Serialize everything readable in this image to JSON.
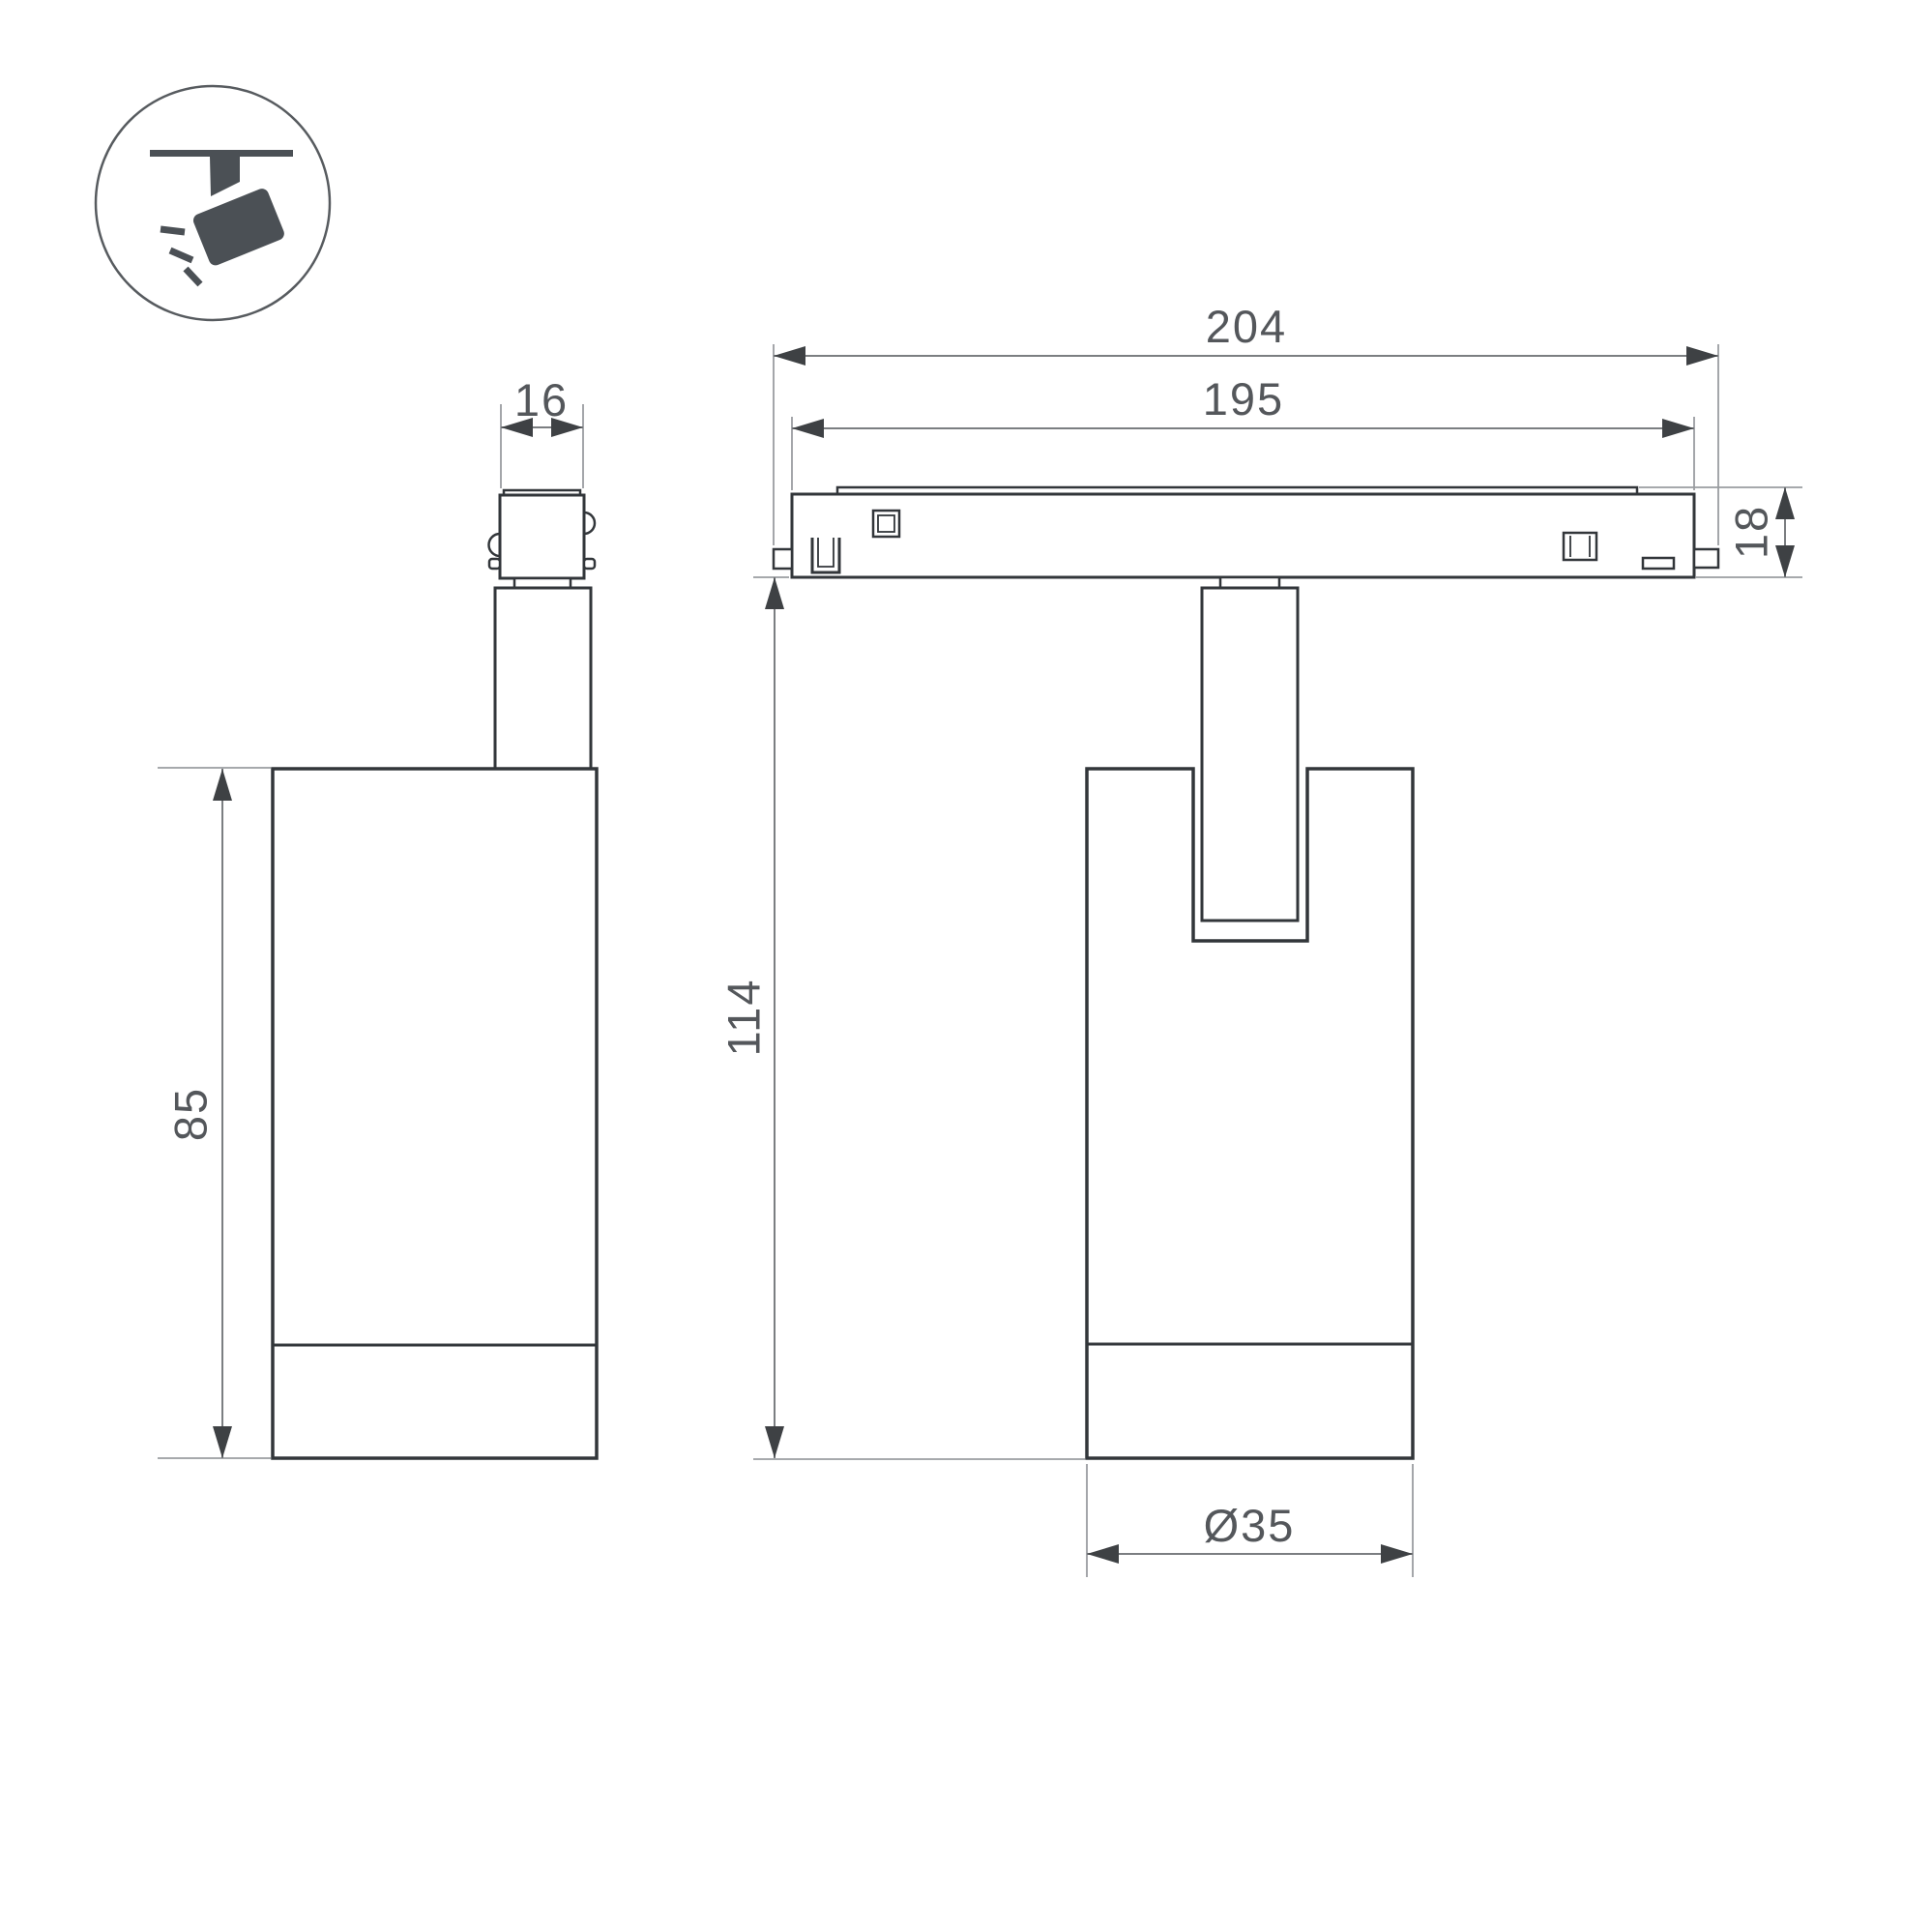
{
  "icon": {
    "name": "track-spotlight-icon",
    "description": "spotlight hanging from ceiling track, tilted, emitting rays"
  },
  "views": {
    "side": {
      "dims": {
        "connector_width": "16",
        "body_height": "85"
      }
    },
    "front": {
      "dims": {
        "track_outer_length": "204",
        "track_inner_length": "195",
        "track_profile_height": "18",
        "overall_height": "114",
        "body_diameter": "Ø35"
      }
    }
  },
  "colors": {
    "background": "#ffffff",
    "part_outline": "#32363a",
    "dimension_line": "#7b7e81",
    "extension_line": "#9a9da0",
    "arrowhead": "#3e4144",
    "dimension_text": "#54575b",
    "icon_glyph": "#4b5055",
    "icon_circle_stroke": "#575b5f"
  }
}
